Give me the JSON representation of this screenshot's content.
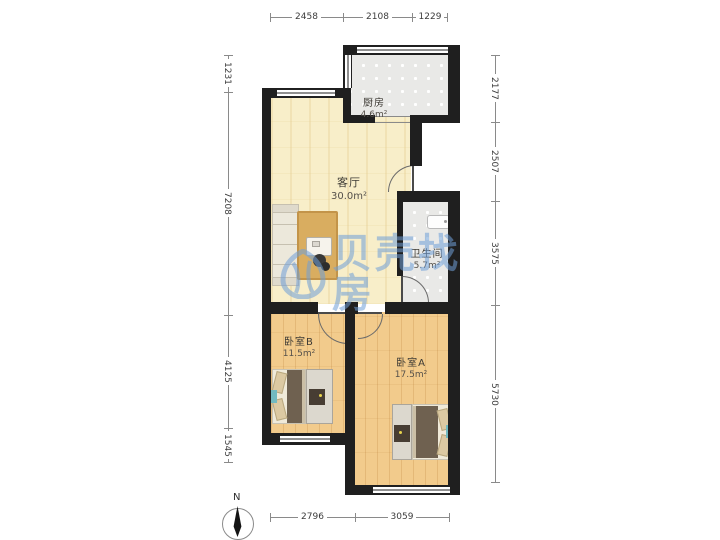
{
  "watermark": {
    "text": "贝壳找房",
    "logo": "beike-shell-logo"
  },
  "compass": {
    "label": "N"
  },
  "rooms": {
    "living": {
      "name": "客厅",
      "area": "30.0m²"
    },
    "kitchen": {
      "name": "厨房",
      "area": "4.6m²"
    },
    "bathroom": {
      "name": "卫生间",
      "area": "5.7m²"
    },
    "bedroom_b": {
      "name": "卧室B",
      "area": "11.5m²"
    },
    "bedroom_a": {
      "name": "卧室A",
      "area": "17.5m²"
    }
  },
  "dimensions": {
    "top": [
      "2458",
      "2108",
      "1229"
    ],
    "bottom": [
      "2796",
      "3059"
    ],
    "left": [
      "1231",
      "7208",
      "4125",
      "1545"
    ],
    "right": [
      "2177",
      "2507",
      "3575",
      "5730"
    ]
  },
  "colors": {
    "wall": "#1f1f1f",
    "living_floor": "#f8eec9",
    "wood_floor": "#f2cb8c",
    "tile_floor": "#e9e9e7",
    "watermark_blue": "#6f9fd8",
    "accent_teal": "#72bac1"
  }
}
